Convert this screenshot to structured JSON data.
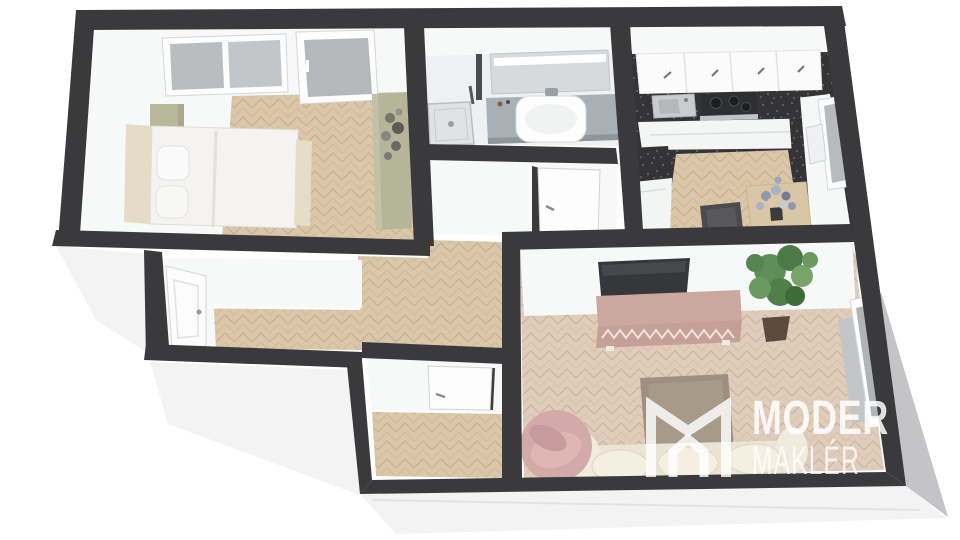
{
  "logo": {
    "mark_icon": "m-monogram-logo",
    "line1": "MODER",
    "line2": "MAKLÉR"
  },
  "scene": {
    "type": "3d-floor-plan-render",
    "rooms": [
      {
        "id": "bedroom",
        "floor": "herringbone-wood",
        "furniture": [
          "double-bed",
          "pillows",
          "headboard-cabinet-sage",
          "wardrobe-sage",
          "dried-flowers",
          "window-two-pane",
          "glass-balcony-door"
        ]
      },
      {
        "id": "bathroom",
        "floor": "light-tile",
        "furniture": [
          "mirror-cabinet-led",
          "vanity-counter",
          "vessel-sink",
          "corner-shower",
          "door"
        ]
      },
      {
        "id": "kitchen",
        "floor": "terrazzo-with-wood-mat",
        "furniture": [
          "upper-cabinets",
          "counter-sink",
          "cooktop",
          "side-cabinets",
          "peninsula-counter",
          "dining-table",
          "flower-bouquet",
          "stool",
          "casement-window"
        ]
      },
      {
        "id": "middle-room",
        "floor": "herringbone-wood",
        "furniture": [
          "panel-door"
        ]
      },
      {
        "id": "corridor",
        "floor": "herringbone-wood",
        "furniture": []
      },
      {
        "id": "small-room",
        "floor": "herringbone-wood",
        "furniture": [
          "door"
        ]
      },
      {
        "id": "living-room",
        "floor": "herringbone-wood",
        "furniture": [
          "tv-leaning",
          "sideboard-chevron",
          "potted-plant",
          "ottoman",
          "sofa-cream",
          "armchair-pink",
          "window-balcony-door",
          "curtain-panel"
        ]
      }
    ]
  },
  "colors": {
    "wall": "#3a3a3c",
    "wall_face": "#f7f8f8",
    "exterior_face": "#f3f3f4",
    "exterior_shade": "#c4c4c7",
    "floor_wood": "#dac6a8",
    "floor_wood_line": "#c8b190",
    "floor_living": "#e0ccba",
    "terrazzo": "#343436",
    "cabinet_white": "#fbfbfc",
    "counter_gray": "#a9b0b5",
    "sage_green": "#b5b599",
    "bed_cream": "#e4dcc6",
    "mauve_pink": "#c9a89f",
    "sofa_cream": "#eae4d4",
    "ottoman_taupe": "#9e8f7e",
    "armchair_pink": "#d4a9a9",
    "plant_green": "#5f8f58",
    "glass_gray": "#b4b8bb",
    "logo_white": "#ffffff"
  }
}
